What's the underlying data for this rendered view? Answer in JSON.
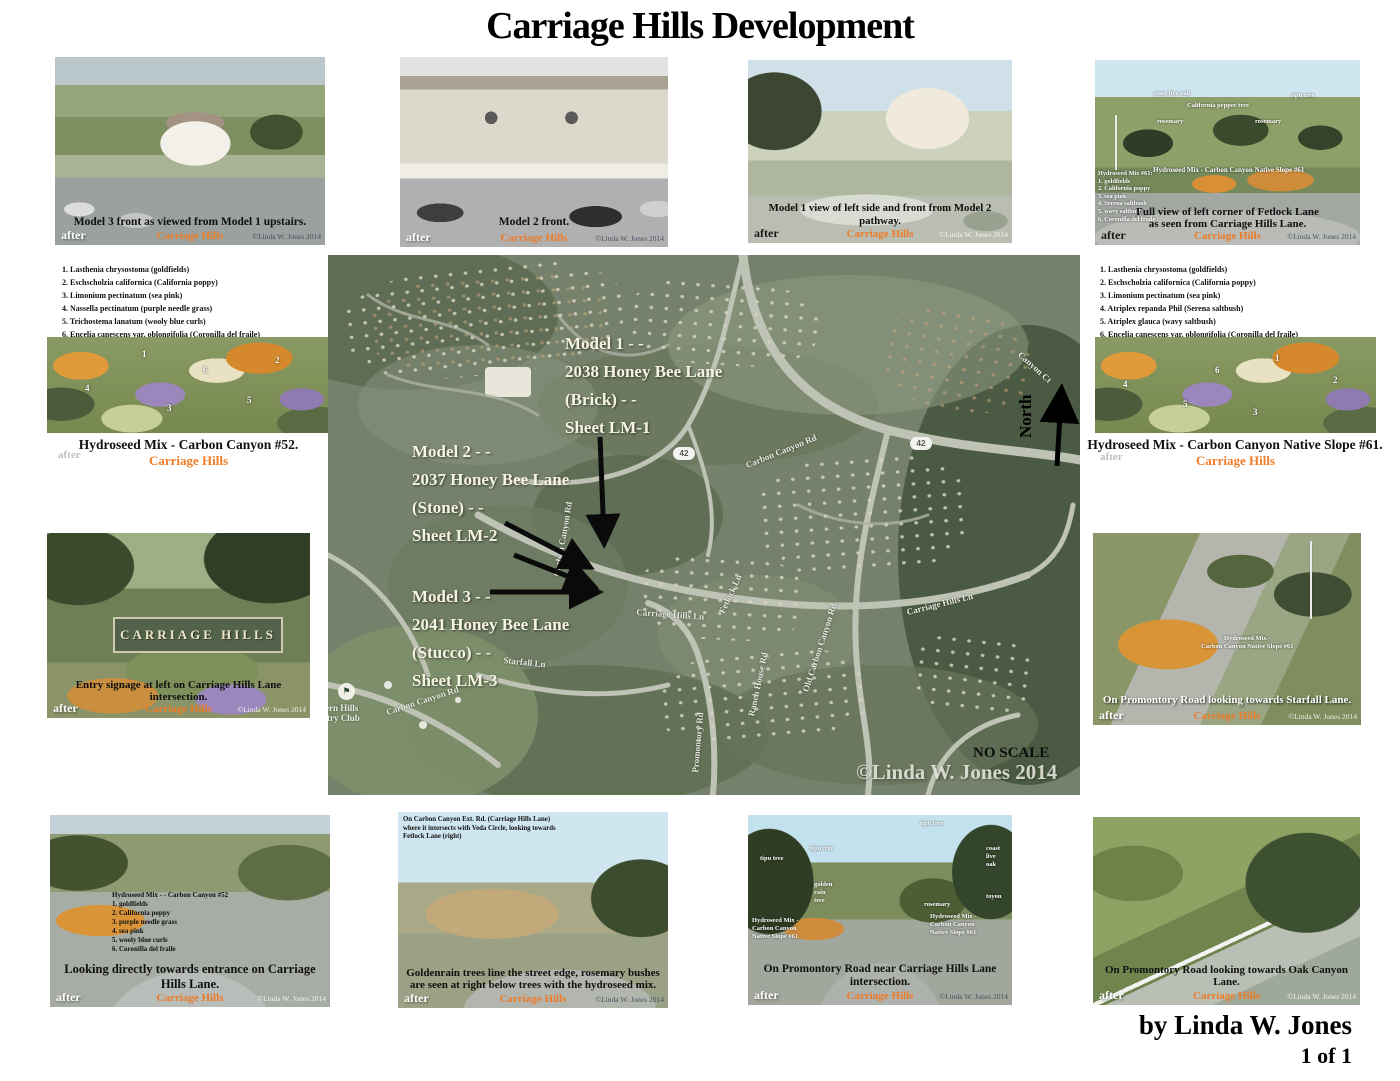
{
  "title": "Carriage Hills Development",
  "labels": {
    "after": "after",
    "brand": "Carriage Hills",
    "credit": "©Linda W. Jones 2014",
    "north": "North"
  },
  "icons": {
    "flag": "⚑"
  },
  "colors": {
    "brand_orange": "#ED7B28",
    "map_green": "#75816B"
  },
  "footer": {
    "byline": "by Linda W. Jones",
    "page": "1 of 1"
  },
  "top_photos": [
    {
      "caption": "Model 3 front as viewed from Model 1 upstairs."
    },
    {
      "caption": "Model 2 front."
    },
    {
      "caption": "Model 1 view of left side and front from Model 2 pathway."
    },
    {
      "caption": "Full view of left corner of Fetlock Lane\nas seen from Carriage Hills Lane.",
      "mix_title": "Hydroseed Mix - Carbon Canyon Native Slope #61",
      "mix_list": "Hydroseed Mix #61:\n1.  goldfields\n2.  California poppy\n3.  sea pink\n4.  Serena saltbush\n5.  wavy saltbush\n6.  Coronilla del fraile",
      "tree_labels": [
        "coast live oak",
        "California pepper tree",
        "rosemary",
        "tipu tree",
        "rosemary"
      ]
    }
  ],
  "left_panel": {
    "plant_list": [
      "1.  Lasthenia chrysostoma (goldfields)",
      "2.  Eschscholzia californica (California poppy)",
      "3.  Limonium pectinatum (sea pink)",
      "4.  Nassella pectinatum (purple needle grass)",
      "5.  Trichostema lanatum (wooly blue curls)",
      "6.  Encelia canescens var. oblongifolia  (Coronilla del fraile)"
    ],
    "hydroseed_caption": "Hydroseed Mix - Carbon Canyon #52.",
    "entry_caption": "Entry signage at left on Carriage Hills Lane intersection.",
    "sign_text": "CARRIAGE HILLS"
  },
  "right_panel": {
    "plant_list": [
      "1.  Lasthenia chrysostoma (goldfields)",
      "2.  Eschscholzia californica (California poppy)",
      "3.  Limonium pectinatum (sea pink)",
      "4.  Atriplex repanda Phil (Serena saltbush)",
      "5.  Atriplex glauca (wavy saltbush)",
      "6.  Encelia canescens var. oblongifolia  (Coronilla del fraile)"
    ],
    "hydroseed_caption": "Hydroseed Mix - Carbon Canyon Native Slope #61.",
    "promontory_caption": "On Promontory Road looking towards Starfall Lane.",
    "promontory_overlay": "Hydroseed Mix -\nCarbon Canyon Native Slope #61"
  },
  "marker_digits": [
    "1",
    "2",
    "3",
    "4",
    "5",
    "6"
  ],
  "map": {
    "annotations": [
      "Model 1 - -\n2038 Honey Bee Lane\n(Brick) - -\nSheet LM-1",
      "Model 2 - -\n2037 Honey Bee Lane\n(Stone) - -\nSheet LM-2",
      "Model 3 - -\n2041 Honey Bee Lane\n(Stucco) - -\nSheet LM-3"
    ],
    "roads": [
      "Carbon Canyon Rd",
      "Carbon Canyon Rd",
      "Carriage Hills Ln",
      "Carriage Hills Ln",
      "Old Carbon Canyon Rd.",
      "Starfall Ln",
      "Promontory Rd",
      "Ranch House Rd",
      "Fetlock Ln",
      "Carbon Canyon Rd",
      "Canyon Ct"
    ],
    "shield": "42",
    "club": "Western Hills\nCountry Club",
    "no_scale": "NO SCALE",
    "credit": "©Linda W. Jones 2014"
  },
  "bottom_photos": [
    {
      "caption": "Looking directly towards entrance on Carriage Hills Lane.",
      "mix_list": "Hydroseed Mix - - Carbon Canyon #52\n1.  goldfields\n2.  California poppy\n3.  purple needle grass\n4.  sea pink\n5.  wooly blue curls\n6.  Coronilla del fraile"
    },
    {
      "caption": "Goldenrain trees line the street edge, rosemary bushes\nare seen at right below trees with the hydroseed mix.",
      "note": "On Carbon Canyon Ext. Rd. (Carriage Hills Lane)\nwhere it intersects with Veda Circle, looking towards\nFetlock Lane (right)"
    },
    {
      "caption": "On Promontory Road near Carriage Hills Lane intersection.",
      "tree_labels": [
        "tipu tree",
        "tipu tree",
        "tipu tree",
        "golden\nrain\ntree",
        "coast\nlive\noak",
        "rosemary",
        "toyon"
      ],
      "mix_left": "Hydroseed Mix -\nCarbon Canyon\nNative Slope #61",
      "mix_right": "Hydroseed Mix -\nCarbon Canyon\nNative Slope #61"
    },
    {
      "caption": "On Promontory Road looking towards Oak Canyon Lane."
    }
  ]
}
